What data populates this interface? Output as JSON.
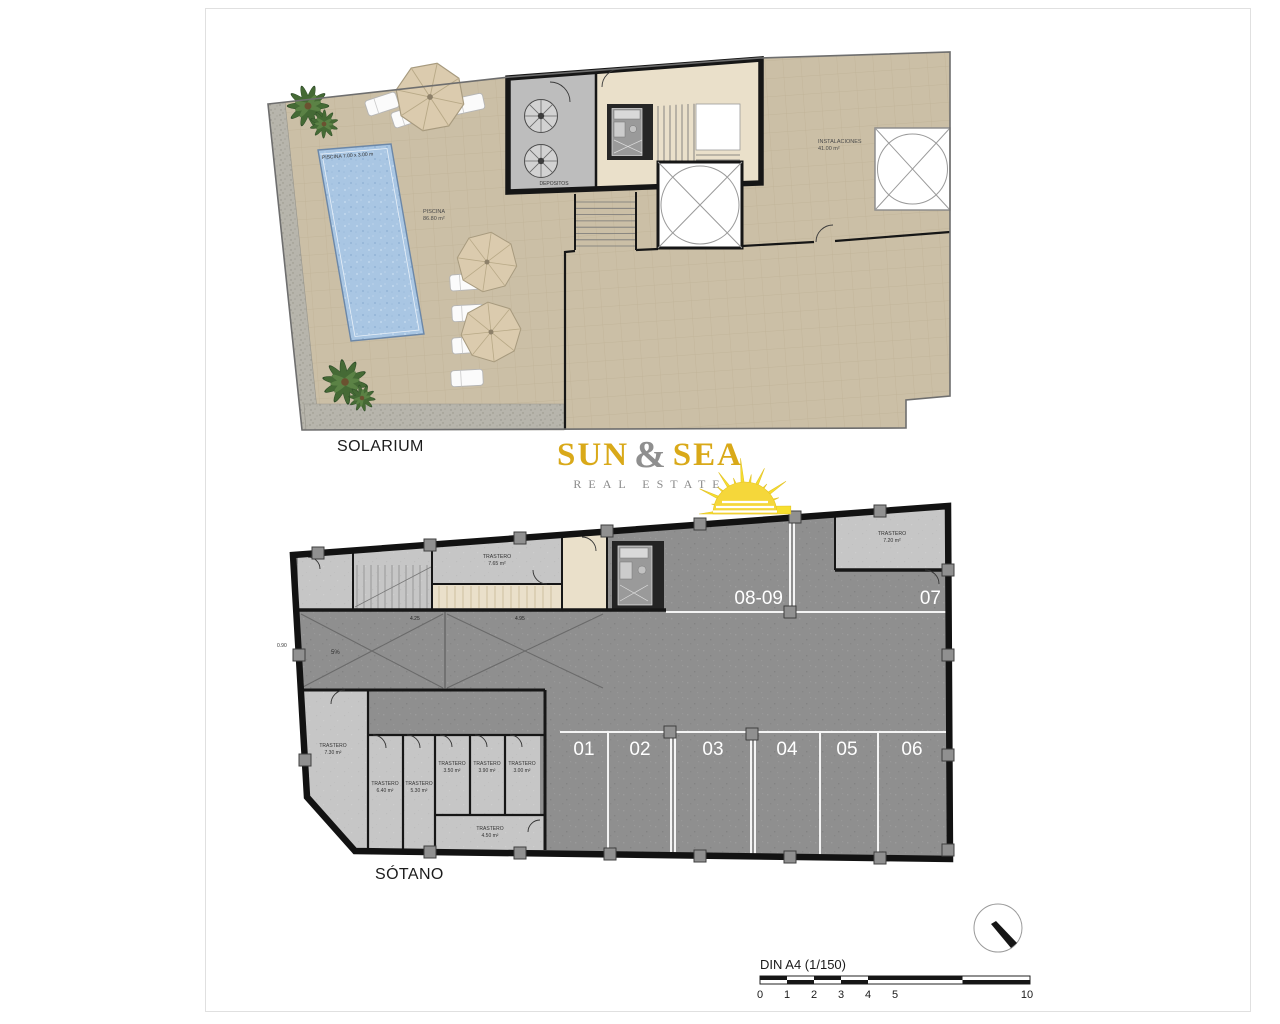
{
  "colors": {
    "terrace_tan": "#cbbfa6",
    "pool_blue": "#a9c6e3",
    "parking_gray": "#8f8f8f",
    "storage_gray": "#c6c6c6",
    "wall_black": "#161616",
    "logo_gold": "#d9a919",
    "logo_gray": "#8a8a8a",
    "sun_yellow": "#f7df2e"
  },
  "solarium": {
    "title": "SOLARIUM",
    "pool_dim_label": "PISCINA 7.00 x 3.00 m",
    "terrace_name": "PISCINA",
    "terrace_area": "86.80 m²",
    "depositos": "DEPOSITOS",
    "instalaciones_name": "INSTALACIONES",
    "instalaciones_area": "41.00 m²"
  },
  "sotano": {
    "title": "SÓTANO",
    "parking_bottom": [
      "01",
      "02",
      "03",
      "04",
      "05",
      "06"
    ],
    "parking_top": [
      "08-09",
      "07"
    ],
    "trasteros": {
      "top": {
        "name": "TRASTERO",
        "area": "7.65 m²"
      },
      "top_right": {
        "name": "TRASTERO",
        "area": "7.20 m²"
      },
      "left": {
        "name": "TRASTERO",
        "area": "7.30 m²"
      },
      "c640": {
        "name": "TRASTERO",
        "area": "6.40 m²"
      },
      "c530": {
        "name": "TRASTERO",
        "area": "5.30 m²"
      },
      "c350": {
        "name": "TRASTERO",
        "area": "3.50 m²"
      },
      "c390": {
        "name": "TRASTERO",
        "area": "3.90 m²"
      },
      "c300": {
        "name": "TRASTERO",
        "area": "3.00 m²"
      },
      "c450": {
        "name": "TRASTERO",
        "area": "4.50 m²"
      }
    },
    "ramp_slope": "5%",
    "dims": {
      "left": "0.90",
      "bay1": "4.25",
      "bay2": "4.95"
    }
  },
  "logo": {
    "word1": "SUN",
    "amp": "&",
    "word2": "SEA",
    "tagline": "REAL ESTATE"
  },
  "scale": {
    "label": "DIN A4 (1/150)",
    "ticks": [
      "0",
      "1",
      "2",
      "3",
      "4",
      "5",
      "10"
    ]
  }
}
